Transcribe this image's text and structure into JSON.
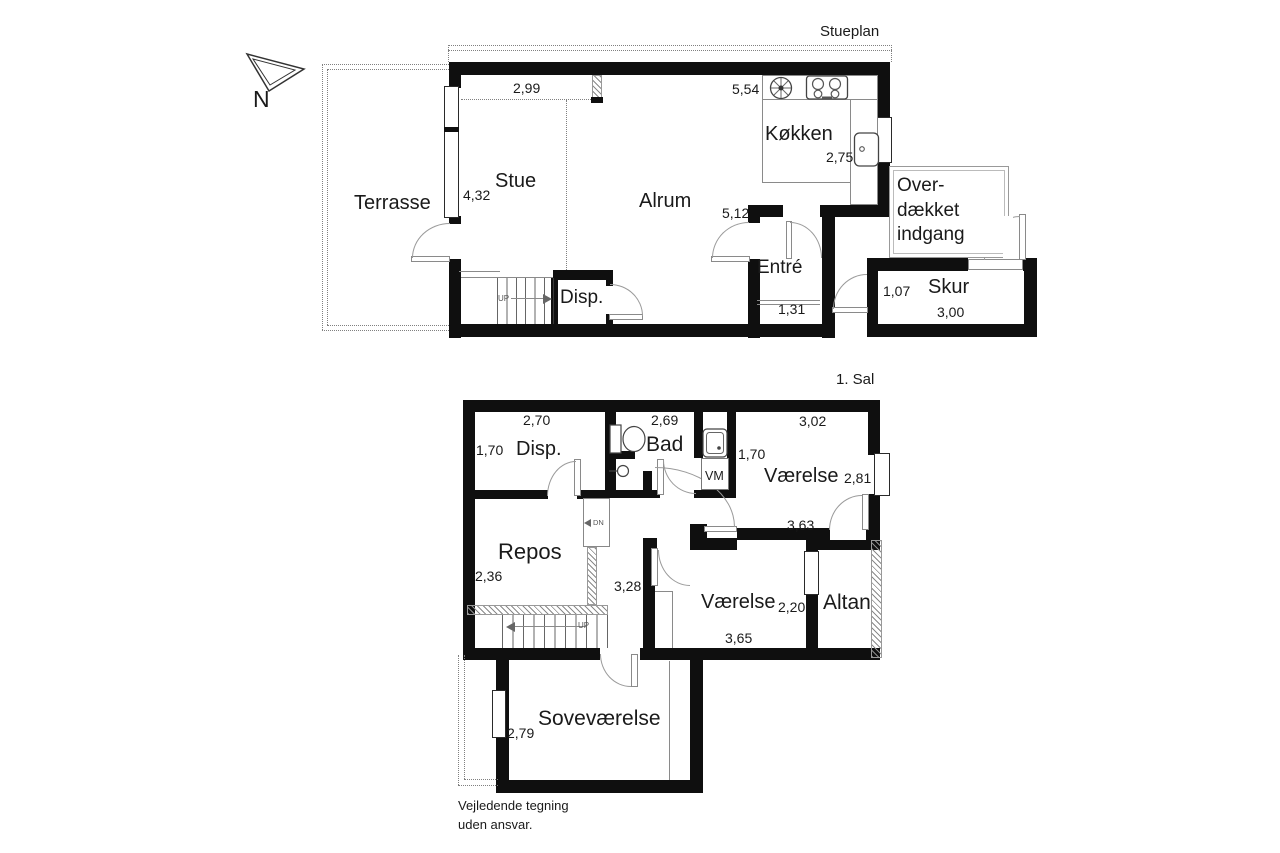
{
  "titles": {
    "ground": "Stueplan",
    "first": "1. Sal"
  },
  "compass": {
    "label": "N"
  },
  "footer": {
    "disclaimer": "Vejledende tegning\nuden ansvar."
  },
  "colors": {
    "wall": "#0f0f0f",
    "thin_line": "#8a8a8a",
    "text": "#1a1a1a",
    "background": "#ffffff"
  },
  "icons": {
    "compass": "north-arrow-icon",
    "kitchen": [
      "round-sink-icon",
      "stove-icon",
      "kitchen-sink-icon"
    ],
    "bathroom": [
      "toilet-icon",
      "hand-basin-icon",
      "washbasin-icon"
    ]
  },
  "ground": {
    "rooms": {
      "terrasse": "Terrasse",
      "stue": "Stue",
      "alrum": "Alrum",
      "kokken": "Køkken",
      "entre": "Entré",
      "disp": "Disp.",
      "skur": "Skur",
      "overdaekket": "Over-\ndækket\nindgang"
    },
    "dims": {
      "d299": "2,99",
      "d554": "5,54",
      "d432": "4,32",
      "d275": "2,75",
      "d512": "5,12",
      "d131": "1,31",
      "d107": "1,07",
      "d300": "3,00"
    },
    "stair_up": "UP"
  },
  "first": {
    "rooms": {
      "disp": "Disp.",
      "bad": "Bad",
      "vaerelse1": "Værelse",
      "repos": "Repos",
      "vaerelse2": "Værelse",
      "altan": "Altan",
      "sovevaerelse": "Soveværelse"
    },
    "dims": {
      "d270": "2,70",
      "d269": "2,69",
      "d302": "3,02",
      "d170l": "1,70",
      "d170r": "1,70",
      "d281": "2,81",
      "d363": "3,63",
      "d236": "2,36",
      "d328": "3,28",
      "d220": "2,20",
      "d365": "3,65",
      "d279": "2,79"
    },
    "stair_up": "UP",
    "stair_dn": "DN",
    "vm": "VM"
  }
}
